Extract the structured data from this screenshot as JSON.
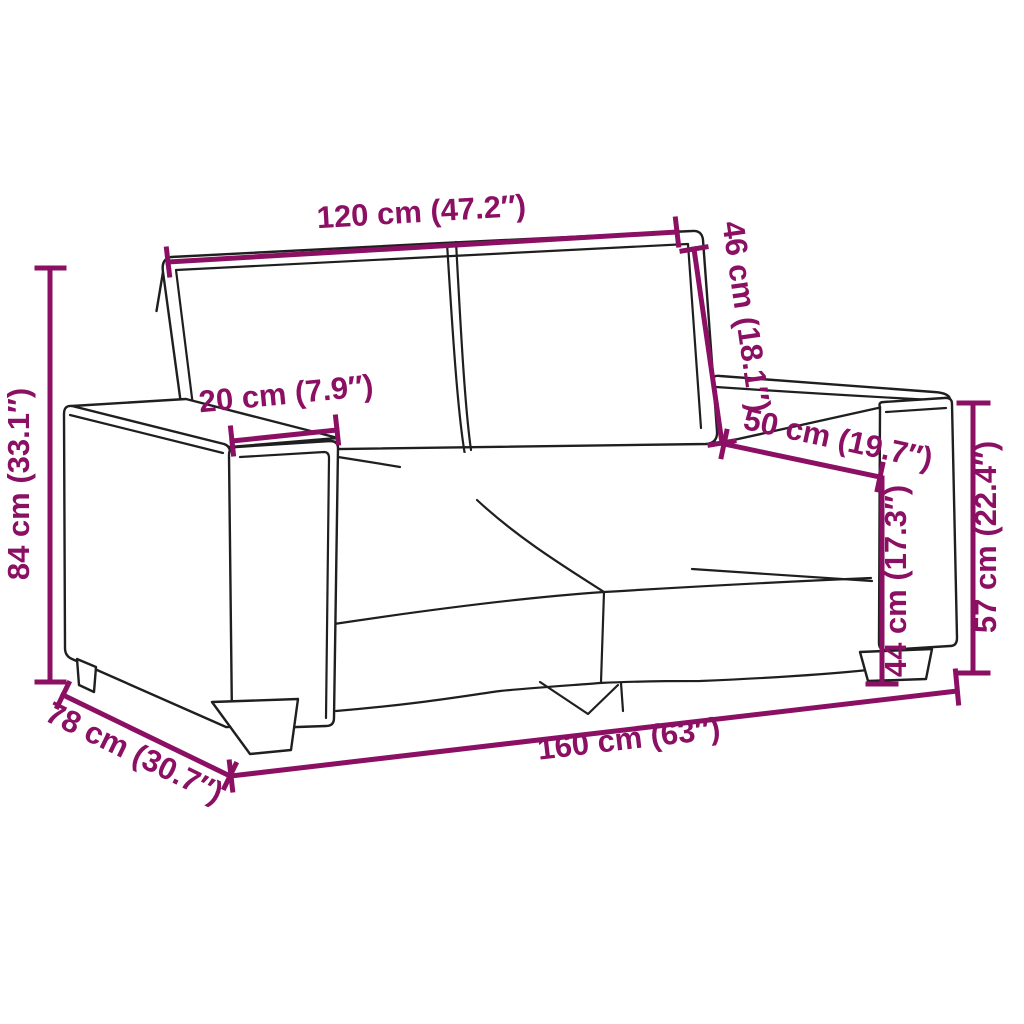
{
  "diagram": {
    "kind": "sofa-dimension-diagram",
    "colors": {
      "dimension_annotation": "#8B1063",
      "drawing_outline": "#1F1F1F",
      "background": "#FFFFFF"
    },
    "measurements": [
      {
        "id": "backrest_width",
        "label": "120 cm (47.2″)",
        "cm": 120,
        "inches": 47.2
      },
      {
        "id": "back_cushion_height",
        "label": "46 cm (18.1″)",
        "cm": 46,
        "inches": 18.1
      },
      {
        "id": "armrest_width",
        "label": "20 cm (7.9″)",
        "cm": 20,
        "inches": 7.9
      },
      {
        "id": "seat_depth",
        "label": "50 cm (19.7″)",
        "cm": 50,
        "inches": 19.7
      },
      {
        "id": "total_height",
        "label": "84 cm (33.1″)",
        "cm": 84,
        "inches": 33.1
      },
      {
        "id": "armrest_height",
        "label": "57 cm (22.4″)",
        "cm": 57,
        "inches": 22.4
      },
      {
        "id": "seat_height",
        "label": "44 cm (17.3″)",
        "cm": 44,
        "inches": 17.3
      },
      {
        "id": "total_depth",
        "label": "78 cm (30.7″)",
        "cm": 78,
        "inches": 30.7
      },
      {
        "id": "total_width",
        "label": "160 cm (63″)",
        "cm": 160,
        "inches": 63
      }
    ]
  }
}
